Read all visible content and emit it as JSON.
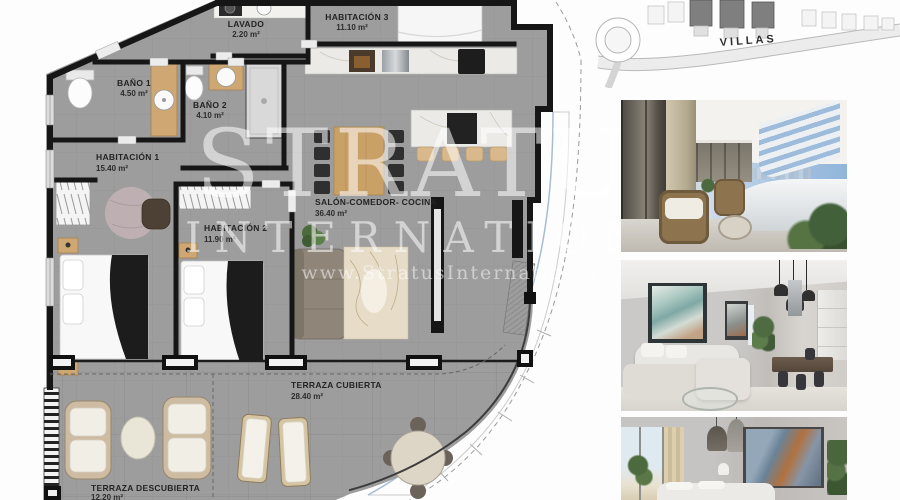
{
  "watermark": {
    "brand": "STRATUS",
    "brand_sub": "INTERNATIONAL",
    "website": "www.StratusInternational"
  },
  "site_map": {
    "road_label": "VILLAS"
  },
  "floor_plan": {
    "rooms": [
      {
        "name": "LAVADO",
        "area": "2.20 m²"
      },
      {
        "name": "HABITACIÓN 3",
        "area": "11.10 m²"
      },
      {
        "name": "BAÑO 1",
        "area": "4.50 m²"
      },
      {
        "name": "BAÑO 2",
        "area": "4.10 m²"
      },
      {
        "name": "HABITACIÓN 1",
        "area": "15.40 m²"
      },
      {
        "name": "HABITACIÓN 2",
        "area": "11.90 m²"
      },
      {
        "name": "SALÓN-COMEDOR- COCINA",
        "area": "36.40 m²"
      },
      {
        "name": "TERRAZA CUBIERTA",
        "area": "28.40 m²"
      },
      {
        "name": "TERRAZA DESCUBIERTA",
        "area": "12.20 m²"
      }
    ]
  },
  "colors": {
    "floor_gray": "#9d9d9d",
    "wall_black": "#161616",
    "wood": "#c9a167",
    "label_text": "#232323"
  }
}
